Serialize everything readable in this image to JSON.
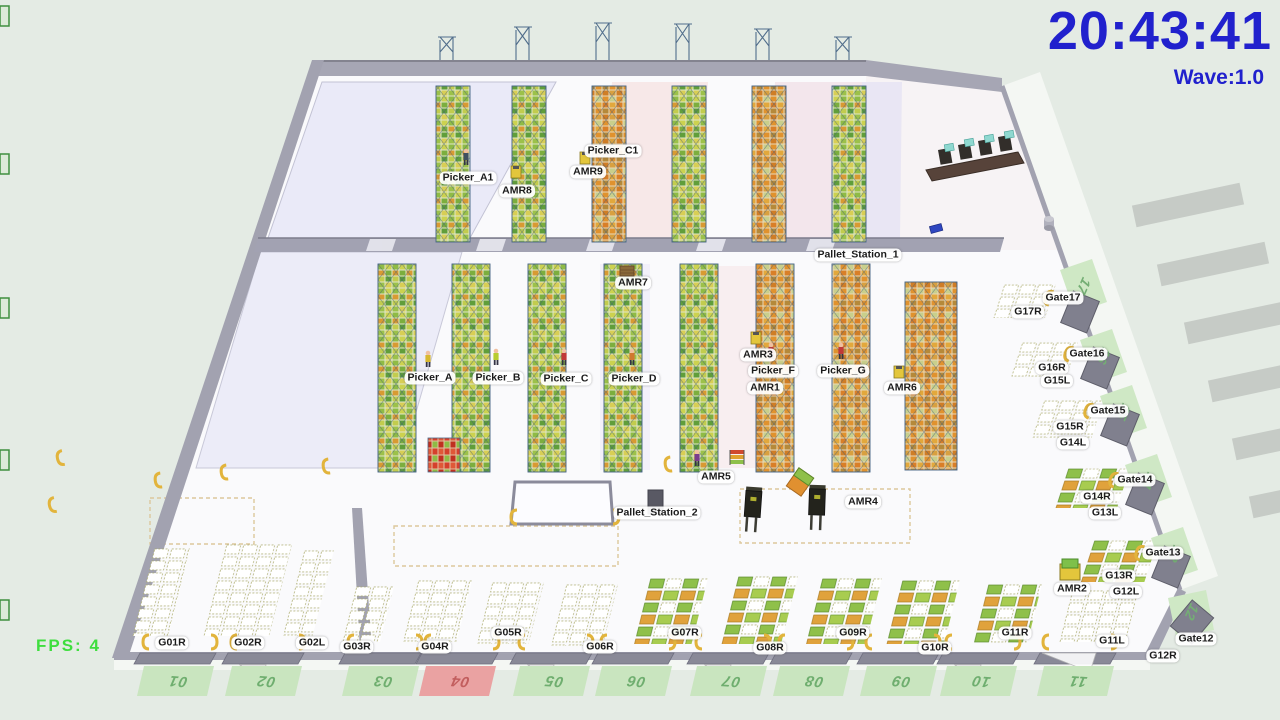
{
  "hud": {
    "clock": "20:43:41",
    "wave": "Wave:1.0",
    "fps": "FPS: 4"
  },
  "colors": {
    "hud_blue": "#2121cd",
    "hud_green": "#3ede3e",
    "ramp_green_pad": "#c9e5bf",
    "ramp_red_pad": "#eaa2a2",
    "ramp_green_text": "#6fae6f",
    "ramp_red_text": "#c25e5e"
  },
  "entities": {
    "picker_a1": "Picker_A1",
    "amr8": "AMR8",
    "amr9": "AMR9",
    "picker_c1": "Picker_C1",
    "amr7": "AMR7",
    "pallet_station_1": "Pallet_Station_1",
    "picker_a": "Picker_A",
    "picker_b": "Picker_B",
    "picker_c": "Picker_C",
    "picker_d": "Picker_D",
    "amr3": "AMR3",
    "picker_f": "Picker_F",
    "picker_g": "Picker_G",
    "amr1": "AMR1",
    "amr6": "AMR6",
    "amr5": "AMR5",
    "pallet_station_2": "Pallet_Station_2",
    "amr4": "AMR4",
    "amr2": "AMR2"
  },
  "right_gates": {
    "gate17": "Gate17",
    "g17r": "G17R",
    "gate16": "Gate16",
    "g16r": "G16R",
    "g15l": "G15L",
    "gate15": "Gate15",
    "g15r": "G15R",
    "g14l": "G14L",
    "gate14": "Gate14",
    "g14r": "G14R",
    "g13l": "G13L",
    "gate13": "Gate13",
    "g13r": "G13R",
    "g12l": "G12L",
    "gate12": "Gate12",
    "g12r": "G12R",
    "g11l": "G11L"
  },
  "bottom_gates": {
    "g01r": "G01R",
    "g02r": "G02R",
    "g02l": "G02L",
    "g03r": "G03R",
    "g04r": "G04R",
    "g05r": "G05R",
    "g06r": "G06R",
    "g07r": "G07R",
    "g08r": "G08R",
    "g09r": "G09R",
    "g10r": "G10R",
    "g11r": "G11R"
  },
  "ramps_bottom": [
    "01",
    "02",
    "03",
    "04",
    "05",
    "06",
    "07",
    "08",
    "09",
    "10",
    "11"
  ],
  "ramps_right": [
    "17",
    "16",
    "15",
    "14",
    "13",
    "12"
  ]
}
